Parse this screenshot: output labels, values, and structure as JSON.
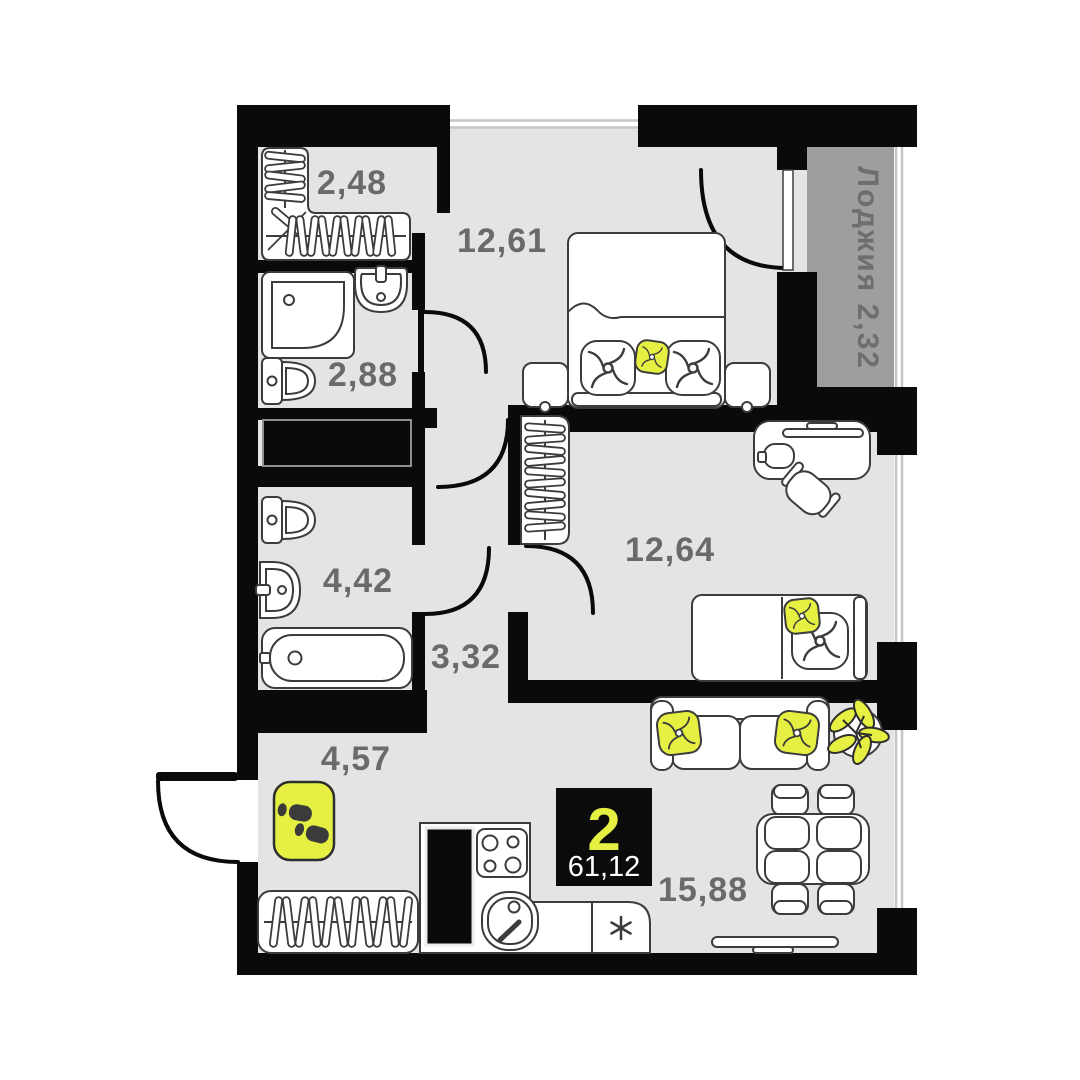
{
  "plan": {
    "type": "apartment-floor-plan",
    "rooms": [
      {
        "name": "wardrobe-storage",
        "area": "2,48"
      },
      {
        "name": "bedroom",
        "area": "12,61"
      },
      {
        "name": "bathroom-shower",
        "area": "2,88"
      },
      {
        "name": "bathroom",
        "area": "4,42"
      },
      {
        "name": "hallway",
        "area": "3,32"
      },
      {
        "name": "bedroom-2",
        "area": "12,64"
      },
      {
        "name": "entry-hall",
        "area": "4,57"
      },
      {
        "name": "kitchen-living-room",
        "area": "15,88"
      }
    ],
    "loggia": {
      "label": "Лоджия  2,32"
    },
    "badge": {
      "room_count": "2",
      "total_area": "61,12"
    },
    "icons": {
      "kitchen_appliance": "asterisk-icon",
      "doormat": "footprints-icon",
      "pillows": "fan-pillow-icon",
      "plant": "plant-icon"
    },
    "colors": {
      "accent": "#e5f042",
      "wall": "#0a0a0a",
      "floor": "#e4e4e4",
      "loggia_fill": "#9e9e9e",
      "label_text": "#6a6a6a"
    }
  }
}
